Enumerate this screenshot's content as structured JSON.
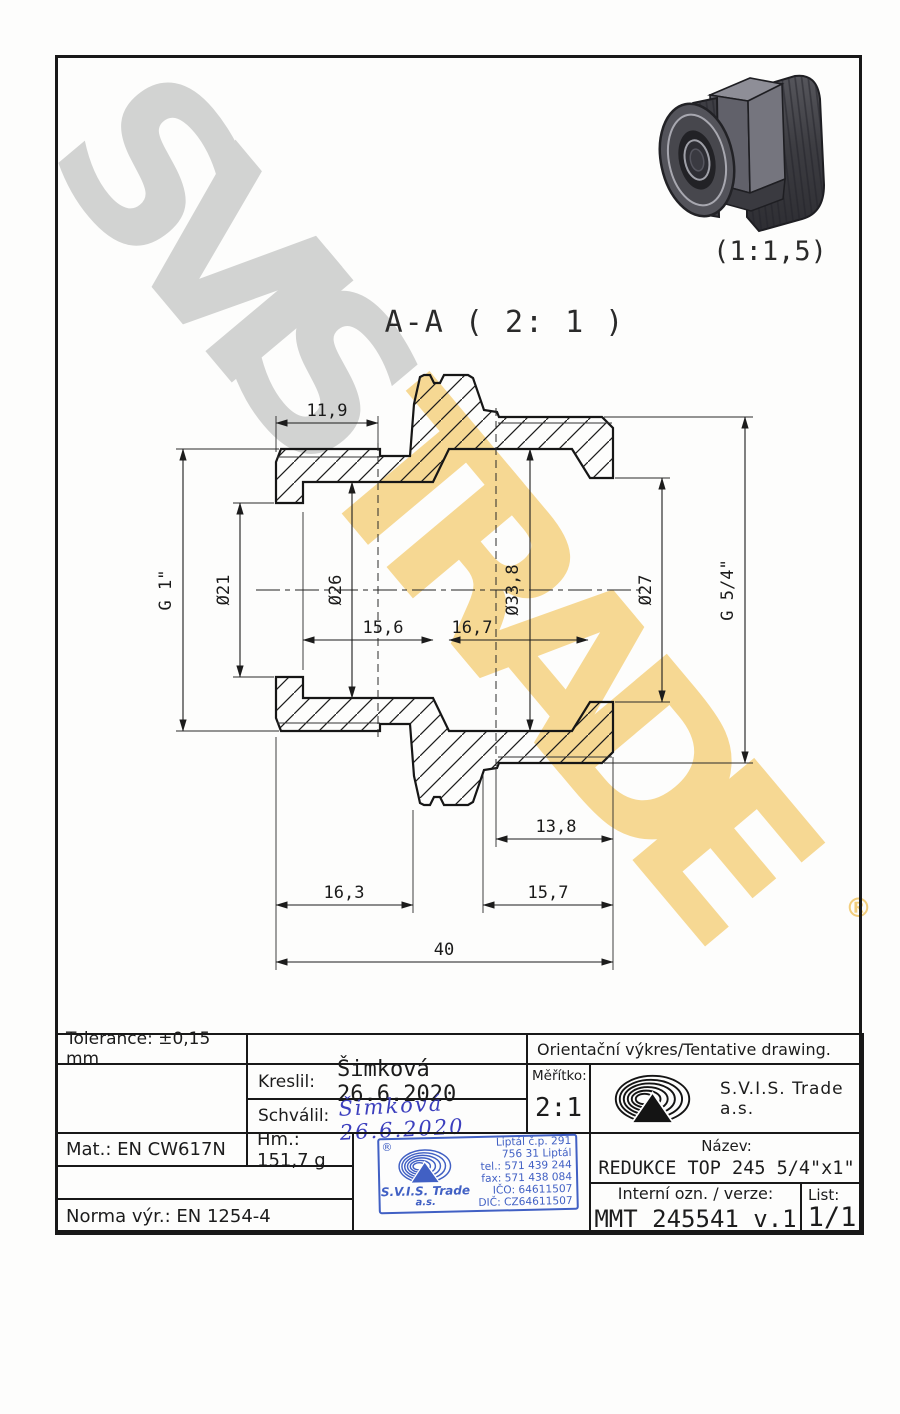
{
  "watermark": {
    "word1": "SVIS",
    "word2": "TRADE",
    "registered": "®"
  },
  "drawing": {
    "section_label": "A-A ( 2: 1 )",
    "pictorial_scale": "(1:1,5)",
    "dims": {
      "len_thread_small": "11,9",
      "thread_small": "G 1\"",
      "bore_small": "Ø21",
      "counterbore": "Ø26",
      "depth_counterbore": "15,6",
      "depth_large_bore": "16,7",
      "bore_large": "Ø33,8",
      "bore_out": "Ø27",
      "thread_large": "G 5/4\"",
      "len_thread_large": "13,8",
      "len_small_end": "16,3",
      "len_large_end": "15,7",
      "overall": "40"
    }
  },
  "title_block": {
    "tolerance": "Tolerance: ±0,15 mm",
    "orientation_note": "Orientační výkres/Tentative drawing.",
    "kreslil_label": "Kreslil:",
    "kreslil_value": "Šimková 26.6.2020",
    "schvalil_label": "Schválil:",
    "schvalil_signature": "Šimková 26.6.2020",
    "meritko_label": "Měřítko:",
    "meritko_value": "2:1",
    "company": "S.V.I.S. Trade a.s.",
    "mat": "Mat.: EN CW617N",
    "hm": "Hm.: 151,7 g",
    "norma": "Norma výr.: EN 1254-4",
    "nazev_label": "Název:",
    "nazev_value": "REDUKCE TOP 245 5/4\"x1\"",
    "interni_label": "Interní ozn. / verze:",
    "interni_value": "MMT 245541 v.1",
    "list_label": "List:",
    "list_value": "1/1"
  },
  "stamp": {
    "registered": "®",
    "company": "S.V.I.S. Trade",
    "suffix": "a.s.",
    "line1": "Liptál č.p. 291",
    "line2": "756 31 Liptál",
    "line3": "tel.: 571 439 244",
    "line4": "fax: 571 438 084",
    "line5": "IČO: 64611507",
    "line6": "DIČ: CZ64611507"
  }
}
